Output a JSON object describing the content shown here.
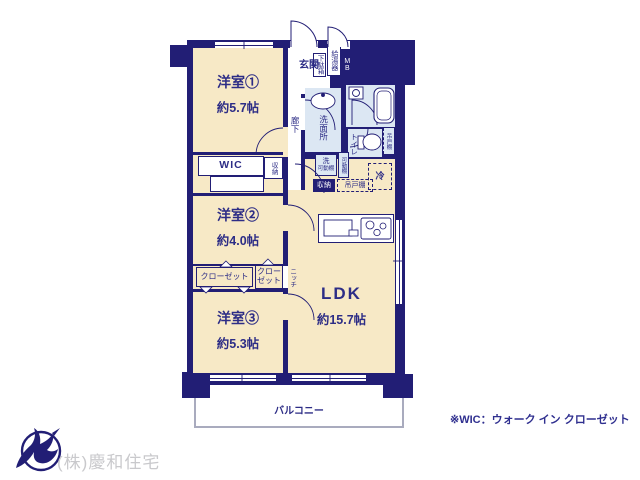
{
  "plan": {
    "rooms": {
      "room1": {
        "name": "洋室①",
        "size": "約5.7帖"
      },
      "room2": {
        "name": "洋室②",
        "size": "約4.0帖"
      },
      "room3": {
        "name": "洋室③",
        "size": "約5.3帖"
      },
      "ldk": {
        "name": "LDK",
        "size": "約15.7帖"
      },
      "genkan": {
        "label": "玄関"
      },
      "corridor": {
        "label": "廊下"
      },
      "washroom": {
        "label": "洗面所"
      },
      "bath": {
        "label": "UB"
      },
      "toilet": {
        "label": "トイレ"
      },
      "wic": {
        "label": "WIC"
      },
      "balcony": {
        "label": "バルコニー"
      }
    },
    "features": {
      "shoe_cabinet": "下駄箱",
      "water_heater": "給湯器",
      "meter_box": "MB",
      "washer": "洗",
      "washer_shelf": "可動棚",
      "movable_shelf": "可動棚",
      "storage_wic": "収納",
      "storage_hall": "収納",
      "cupboard_toilet": "吊戸棚",
      "cupboard_kitchen": "吊戸棚",
      "refrigerator": "冷",
      "closet_left": "クローゼット",
      "closet_right": "クローゼット",
      "niche": "ニッチ"
    },
    "colors": {
      "wall": "#221e75",
      "room_fill": "#f7e9c6",
      "water_fill": "#dce7f3",
      "label_text": "#2d2d86",
      "balcony_border": "#a9abbe"
    },
    "icons": [
      "bathtub-icon",
      "toilet-icon",
      "washbasin-icon",
      "kitchen-sink-icon",
      "stove-icon",
      "door-swing-icon",
      "window-icon"
    ]
  },
  "footer": {
    "company": "(株)慶和住宅",
    "company_color": "#c9c9cc",
    "logo_icon": "swallow-logo-icon",
    "note": "※WIC：ウォーク イン クローゼット"
  }
}
